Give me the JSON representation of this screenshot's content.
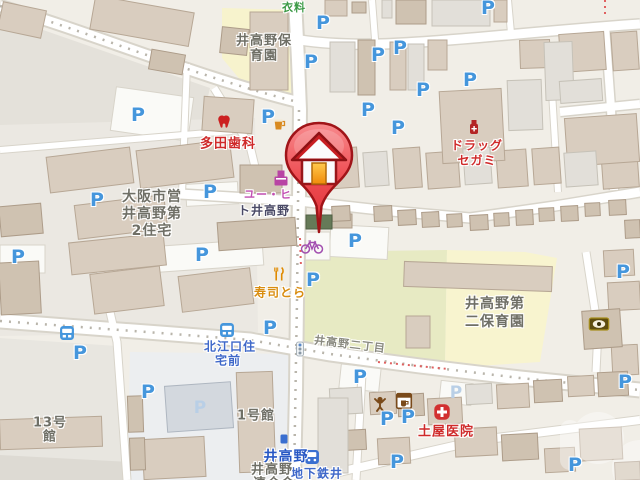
{
  "app": {
    "type": "map-viewer",
    "description": "Japanese street map around Itakano, Osaka"
  },
  "glyphs": {
    "parking": "P"
  },
  "labels": {
    "clothing_store": "衣料",
    "nursery_north_1": "井高野保",
    "nursery_north_2": "育園",
    "dental_clinic": "多田歯科",
    "drugstore_1": "ドラッグ",
    "drugstore_2": "セガミ",
    "shop_1": "ユー・ヒ",
    "shop_2": "ト井高野",
    "housing_1": "大阪市営",
    "housing_2": "井高野第",
    "housing_3": "2住宅",
    "sushi_restaurant": "寿司とら",
    "bus_stop_1": "北江口住",
    "bus_stop_2": "宅前",
    "district_road": "井高野二丁目",
    "nursery_south_1": "井高野第",
    "nursery_south_2": "二保育園",
    "station_name": "井高野",
    "subway_label": "地下鉄井",
    "hall_1": "井高野",
    "hall_2": "連合会",
    "clinic": "土屋医院",
    "building_13_1": "13号",
    "building_13_2": "館",
    "building_1": "1号館"
  },
  "icons": [
    "house-marker-pin",
    "parking-icon",
    "bus-stop-icon",
    "train-station-icon",
    "station-entrance-icon",
    "traffic-signal-icon",
    "dentist-tooth-icon",
    "pub-mug-icon",
    "convenience-store-icon",
    "pharmacy-bottle-icon",
    "restaurant-fork-knife-icon",
    "person-shop-icon",
    "cafe-box-icon",
    "hospital-cross-icon",
    "optician-eye-icon",
    "bicycle-parking-icon"
  ],
  "colors": {
    "parking_blue": "#4596dc",
    "poi_red": "#cf2a2a",
    "poi_magenta": "#c24fb2",
    "poi_green": "#3c9a46",
    "poi_orange": "#d98d10",
    "transit_blue": "#3f68c9",
    "marker_red": "#ee4d52",
    "road_white": "#ffffff",
    "field_green": "#e7eac3",
    "field_yellow": "#f8f4cf",
    "building_tan": "#d9cdbf"
  }
}
